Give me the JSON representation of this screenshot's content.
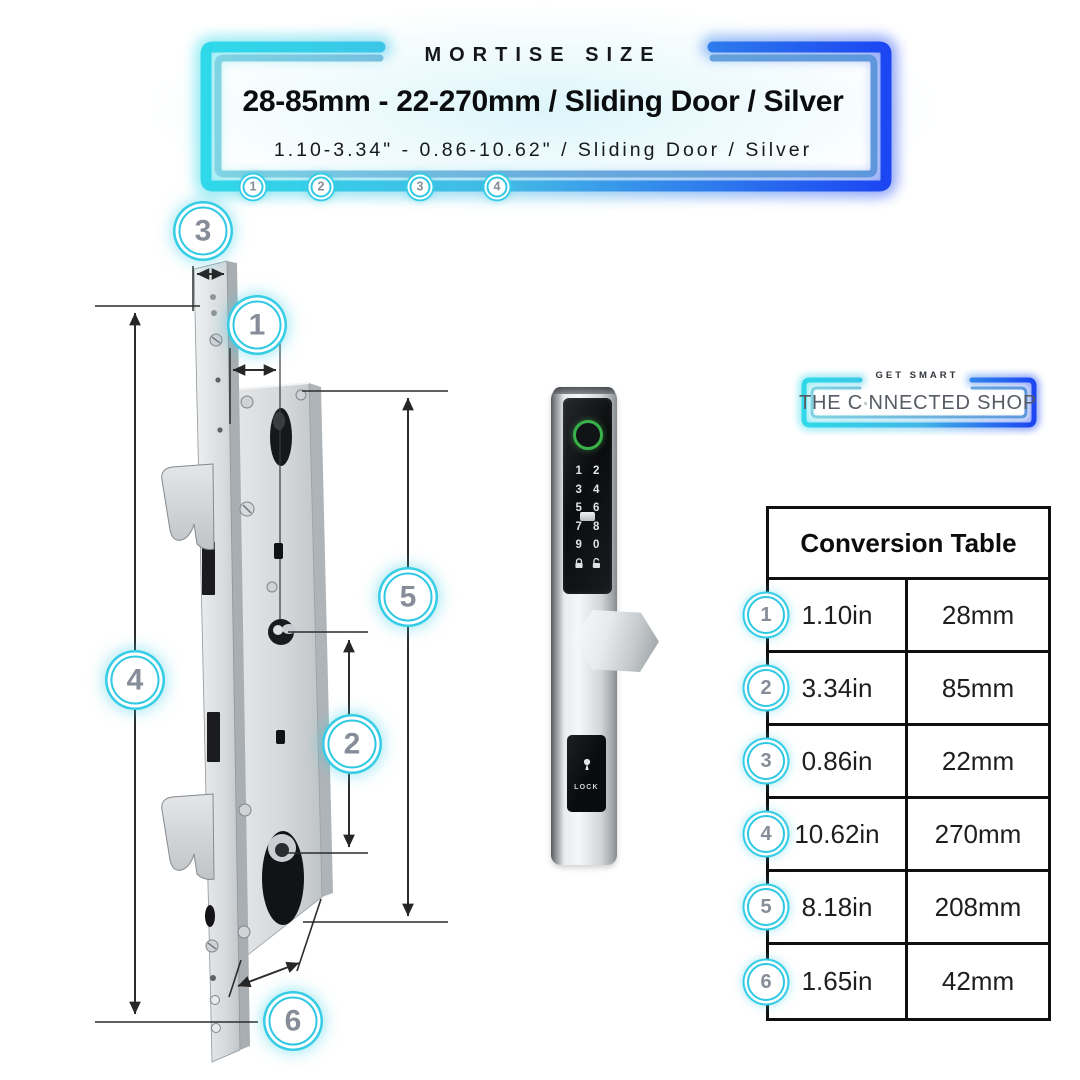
{
  "header": {
    "eyebrow": "MORTISE SIZE",
    "title": "28-85mm - 22-270mm / Sliding Door / Silver",
    "subtitle": "1.10-3.34\" - 0.86-10.62\" / Sliding Door / Silver",
    "markers": [
      "1",
      "2",
      "3",
      "4"
    ]
  },
  "diagram": {
    "callouts": [
      {
        "num": "3"
      },
      {
        "num": "1"
      },
      {
        "num": "5"
      },
      {
        "num": "4"
      },
      {
        "num": "2"
      },
      {
        "num": "6"
      }
    ]
  },
  "product": {
    "keypad_rows": [
      [
        "1",
        "2"
      ],
      [
        "3",
        "4"
      ],
      [
        "5",
        "6"
      ],
      [
        "7",
        "8"
      ],
      [
        "9",
        "0"
      ]
    ],
    "lock_label": "LOCK"
  },
  "logo": {
    "tagline": "GET SMART",
    "brand_prefix": "THE C",
    "brand_suffix": "NNECTED SHOP"
  },
  "conversion_table": {
    "title": "Conversion Table",
    "rows": [
      {
        "num": "1",
        "inches": "1.10in",
        "mm": "28mm"
      },
      {
        "num": "2",
        "inches": "3.34in",
        "mm": "85mm"
      },
      {
        "num": "3",
        "inches": "0.86in",
        "mm": "22mm"
      },
      {
        "num": "4",
        "inches": "10.62in",
        "mm": "270mm"
      },
      {
        "num": "5",
        "inches": "8.18in",
        "mm": "208mm"
      },
      {
        "num": "6",
        "inches": "1.65in",
        "mm": "42mm"
      }
    ]
  },
  "colors": {
    "accent_cyan": "#2fd4e8",
    "accent_blue": "#1c4df1",
    "badge_ring": "#35cce5",
    "badge_number": "#868d98",
    "fingerprint_green": "#39b24a"
  }
}
